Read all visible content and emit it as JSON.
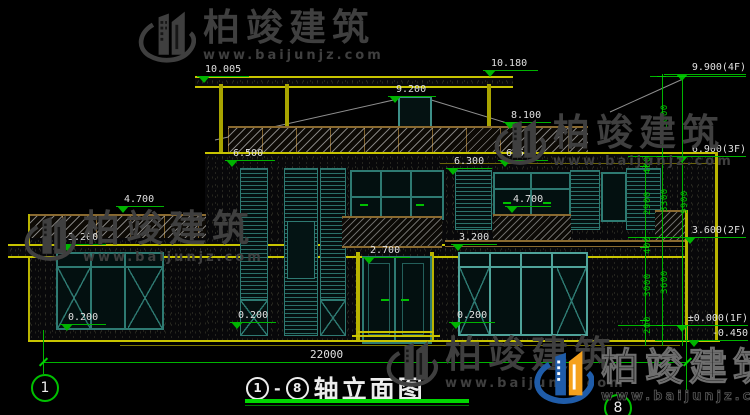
{
  "brand": {
    "name": "柏竣建筑",
    "site": "www.baijunjz.com"
  },
  "drawing_title": {
    "axis_from": "1",
    "dash": "-",
    "axis_to": "8",
    "text": "轴立面图"
  },
  "axis": {
    "left_bubble": "1",
    "right_bubble": "8"
  },
  "levels": {
    "roof_left": "10.005",
    "roof_right": "10.180",
    "roof_window": "9.200",
    "parapet": "8.100",
    "f65_left": "6.500",
    "f65_right": "6.500",
    "f63": "6.300",
    "f47_left": "4.700",
    "f47_right": "4.700",
    "f32_left": "3.200",
    "f32_right": "3.200",
    "door_top": "2.700",
    "sill_left": "0.200",
    "sill_mid": "0.200",
    "sill_right": "0.200"
  },
  "floor_levels": {
    "f4": "9.900(4F)",
    "f3": "6.900(3F)",
    "f2": "3.600(2F)",
    "f1": "±0.000(1F)",
    "grade": "-0.450"
  },
  "vdims": {
    "seg400a": "400",
    "seg2900": "2900",
    "seg400b": "400",
    "seg3000b": "3000",
    "seg200": "200",
    "seg3000a": "3000",
    "seg3300": "3300",
    "seg3600": "3600",
    "total9900": "9900"
  },
  "hdims": {
    "overall_width": "22000"
  },
  "colors": {
    "cad_yellow": "#c8c400",
    "cad_green": "#00c000",
    "cad_teal": "#3d8f88",
    "hatch_brown": "#8a6a30",
    "watermark_gray": "#3f3f3f",
    "logo_blue": "#1f5ca9",
    "logo_orange": "#f5a11c"
  }
}
